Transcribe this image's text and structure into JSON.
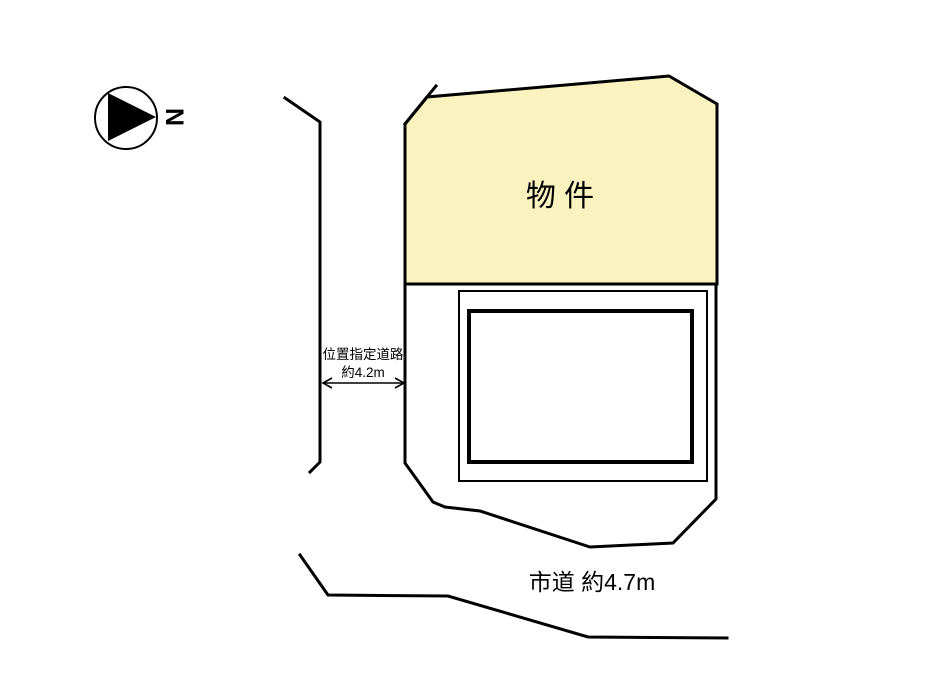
{
  "diagram": {
    "background_color": "#ffffff",
    "line_color": "#000000"
  },
  "compass": {
    "north_label": "N"
  },
  "property": {
    "label": "物 件",
    "fill_color": "#faf3c0"
  },
  "designated_road": {
    "name": "位置指定道路",
    "width": "約4.2m"
  },
  "city_road": {
    "label": "市道 約4.7m"
  },
  "shapes": {
    "property_points": "405,124 427,97 669,76 717,104 717,284 405,284",
    "parcel_points": "405,284 405,463 433,502 445,507 480,511 590,547 673,543 716,499 716,284",
    "corner_tick_points": "405,124 436,86",
    "left_road_points": "285,98 320,122 320,462 310,472",
    "bottom_road_points": "300,555 328,595 448,596 588,637 727,638",
    "arrow_shaft_points": "324,383 403,383",
    "arrow_head_left_points": "332,378 323,383 332,388",
    "arrow_head_right_points": "395,378 404,383 395,388"
  }
}
